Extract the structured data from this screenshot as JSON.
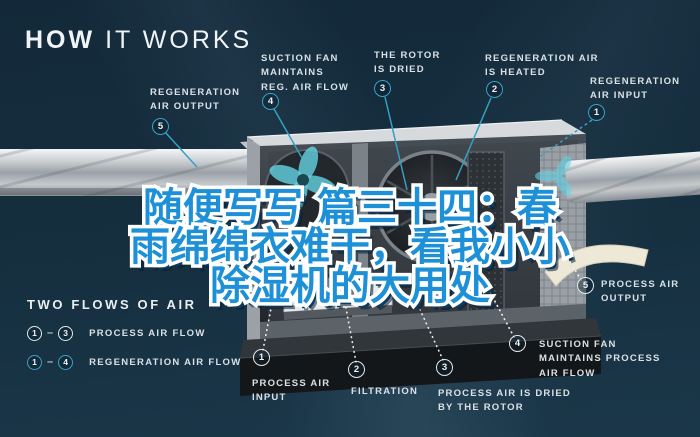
{
  "page_title": {
    "bold": "HOW",
    "light": "IT WORKS"
  },
  "overlay_title": {
    "line1": "随便写写 篇三十四：春",
    "line2": "雨绵绵衣难干，看我小小",
    "line3": "除湿机的大用处"
  },
  "callouts": {
    "regeneration": [
      {
        "num": "5",
        "label": "REGENERATION\nAIR OUTPUT"
      },
      {
        "num": "4",
        "label": "SUCTION FAN\nMAINTAINS\nREG. AIR FLOW"
      },
      {
        "num": "3",
        "label": "THE ROTOR\nIS DRIED"
      },
      {
        "num": "2",
        "label": "REGENERATION AIR\nIS HEATED"
      },
      {
        "num": "1",
        "label": "REGENERATION\nAIR INPUT"
      }
    ],
    "process": [
      {
        "num": "1",
        "label": "PROCESS AIR\nINPUT"
      },
      {
        "num": "2",
        "label": "FILTRATION"
      },
      {
        "num": "3",
        "label": "PROCESS AIR IS DRIED\nBY THE ROTOR"
      },
      {
        "num": "4",
        "label": "SUCTION FAN\nMAINTAINS PROCESS\nAIR FLOW"
      },
      {
        "num": "5",
        "label": "PROCESS AIR\nOUTPUT"
      }
    ]
  },
  "legend": {
    "heading": "TWO FLOWS OF AIR",
    "dash": "–",
    "rows": [
      {
        "from": "1",
        "to": "3",
        "label": "PROCESS AIR FLOW",
        "type": "process"
      },
      {
        "from": "1",
        "to": "4",
        "label": "REGENERATION AIR FLOW",
        "type": "regeneration"
      }
    ]
  },
  "colors": {
    "background": "#14293a",
    "regeneration_accent": "#38a3c6",
    "process_accent": "#e3e9ec",
    "overlay_text_fill": "#1e90d8",
    "overlay_text_outline": "#ffffff",
    "overlay_text_shadow": "#0d3a5e",
    "label_text": "#d9e1e6"
  }
}
